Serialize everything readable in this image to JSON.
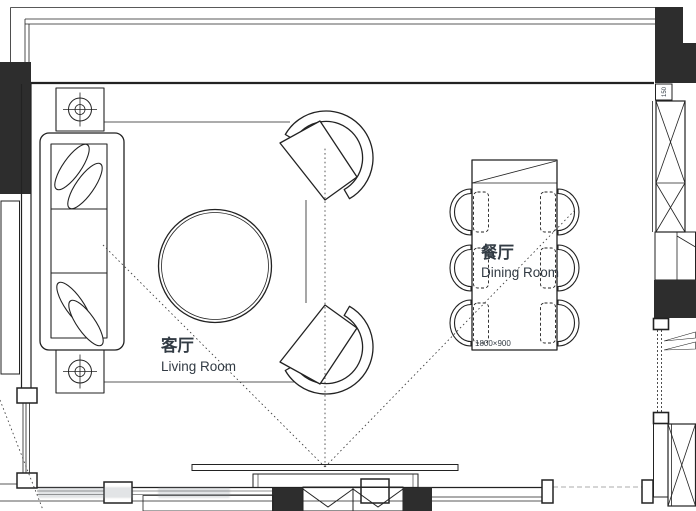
{
  "labels": {
    "living_room_zh": "客厅",
    "living_room_en": "Living Room",
    "dining_room_zh": "餐厅",
    "dining_room_en": "Dining Room",
    "dining_table_size": "1800×900",
    "wall_dim": "150"
  },
  "colors": {
    "line": "#222222",
    "wall": "#2d2d2d",
    "text": "#323b44",
    "paper": "#ffffff"
  }
}
